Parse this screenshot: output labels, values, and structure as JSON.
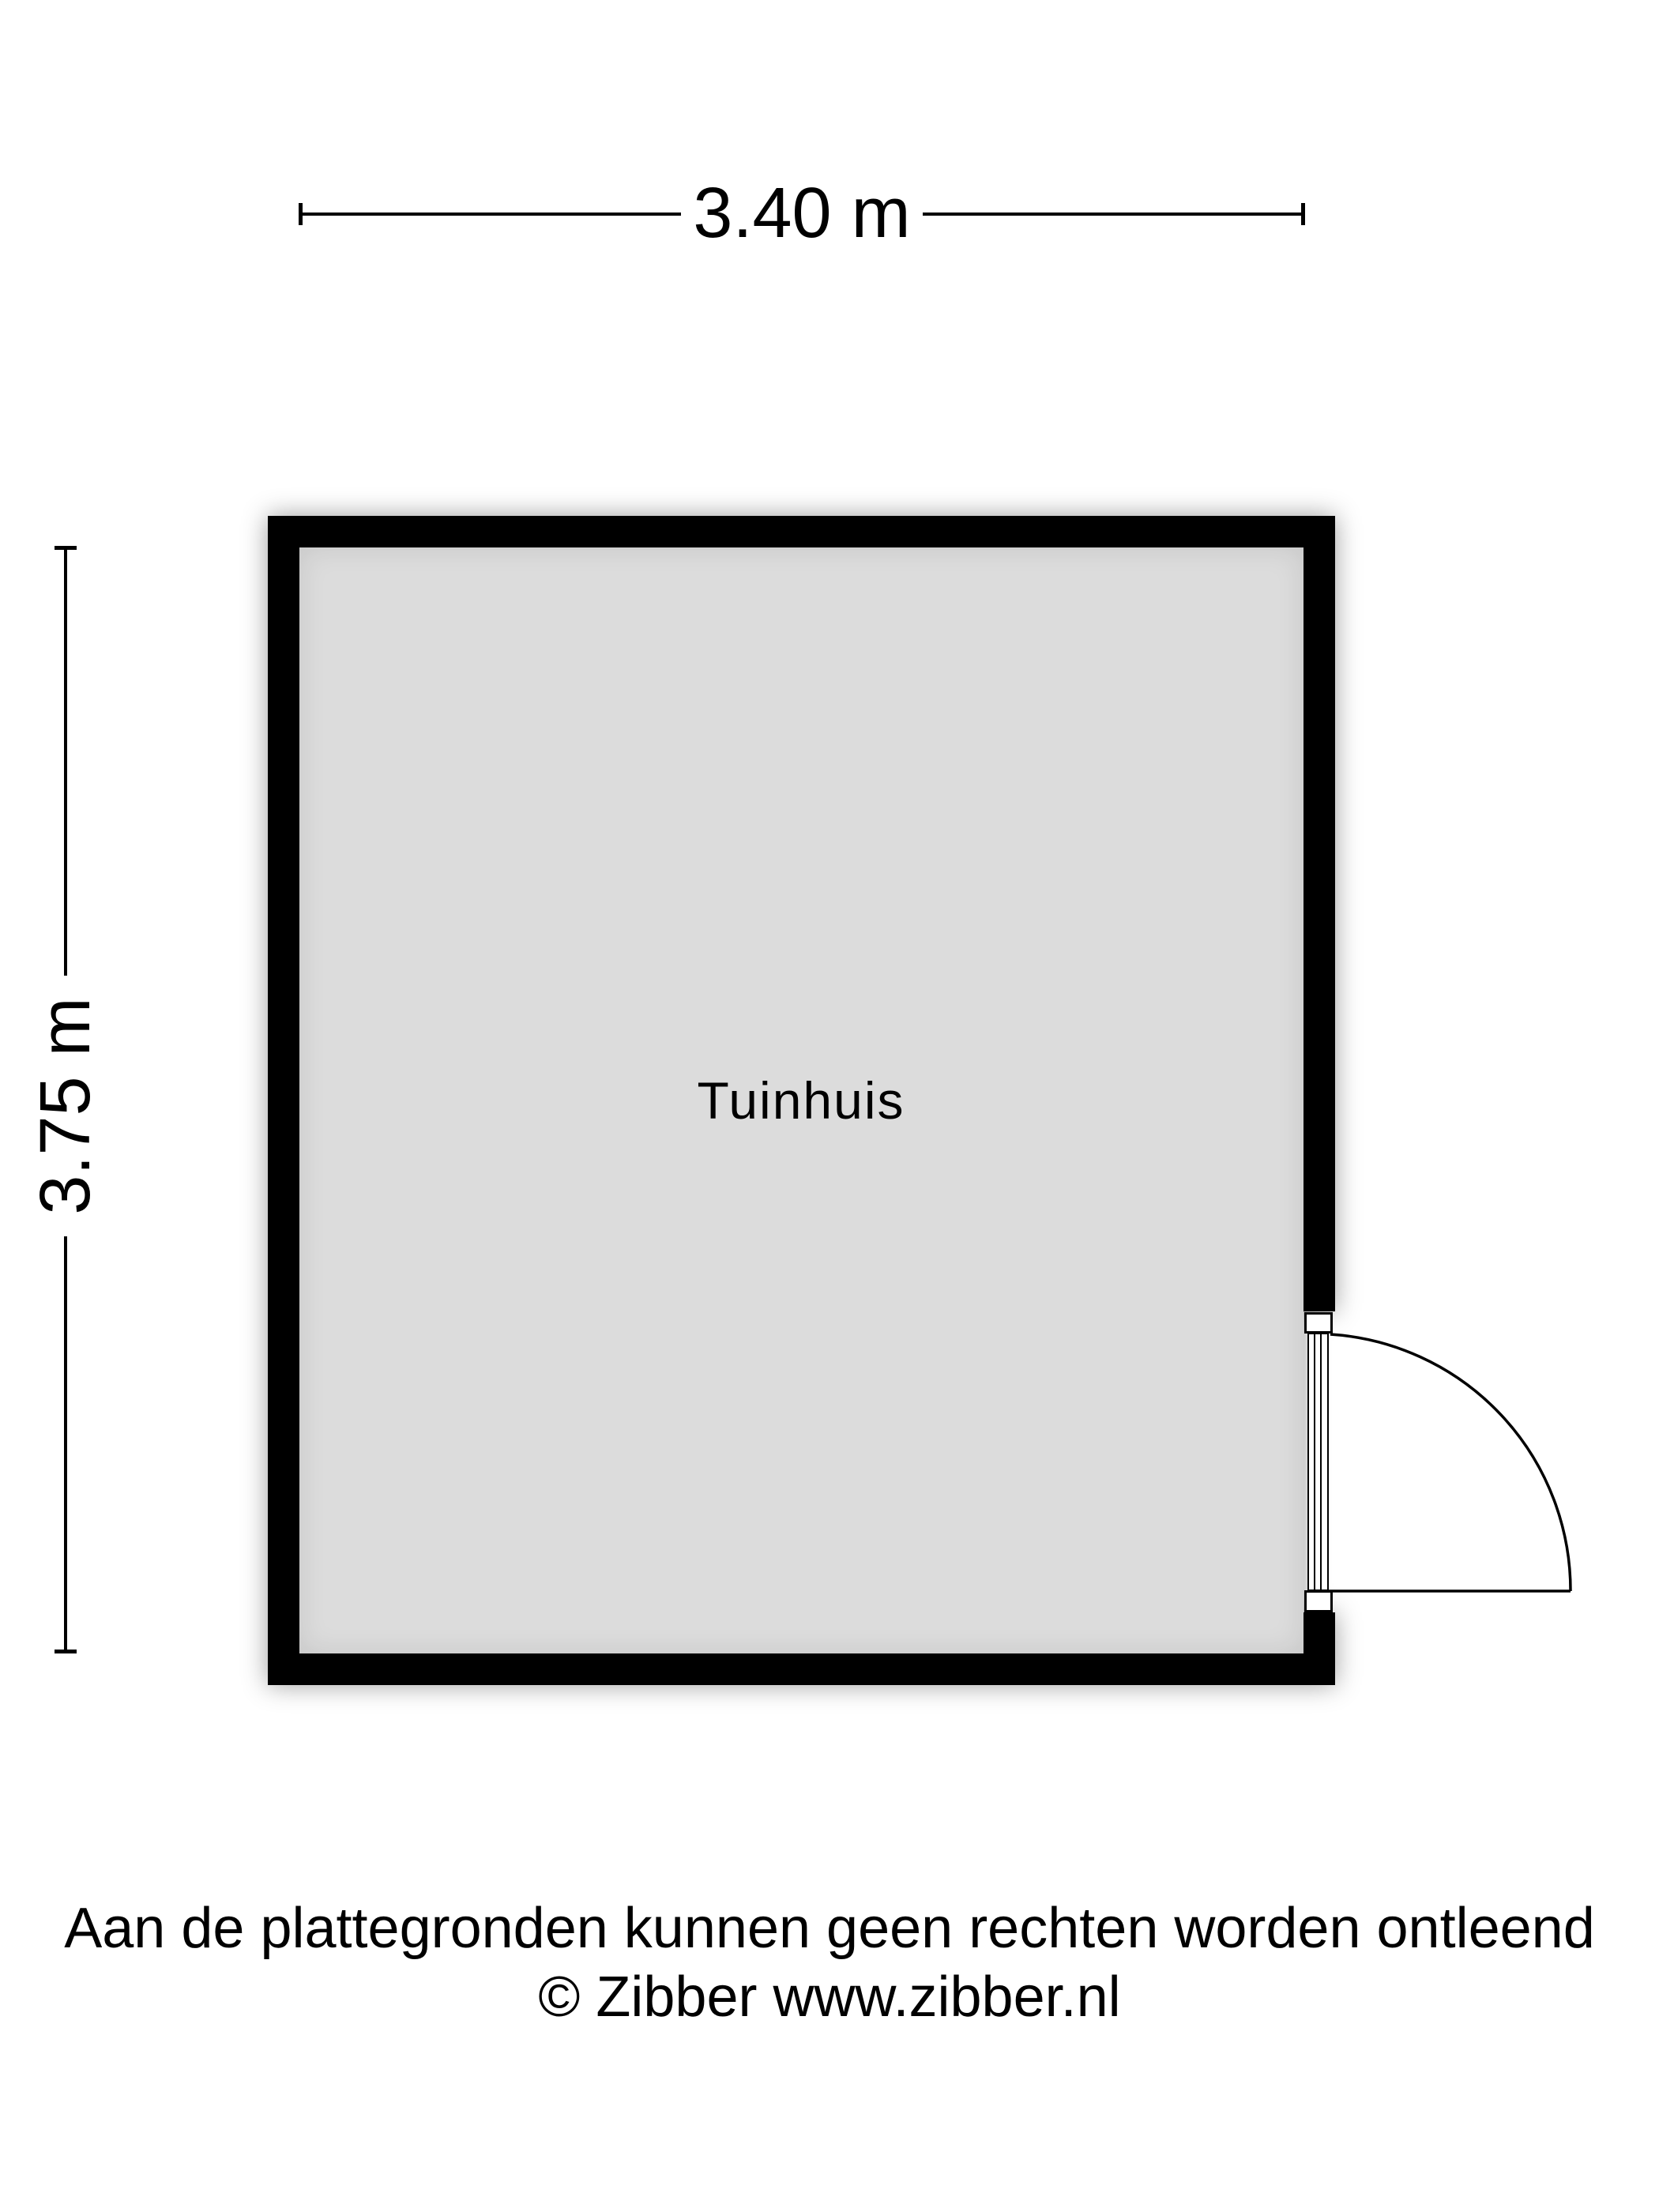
{
  "plan": {
    "room": {
      "label": "Tuinhuis"
    },
    "dimensions": {
      "width_label": "3.40 m",
      "height_label": "3.75 m"
    },
    "door": {
      "type": "single-swing-door"
    }
  },
  "footer": {
    "disclaimer": "Aan de plattegronden kunnen geen rechten worden ontleend",
    "copyright": "© Zibber www.zibber.nl"
  },
  "colors": {
    "wall": "#000000",
    "floor": "#dcdcdc",
    "background": "#ffffff",
    "text": "#000000"
  }
}
